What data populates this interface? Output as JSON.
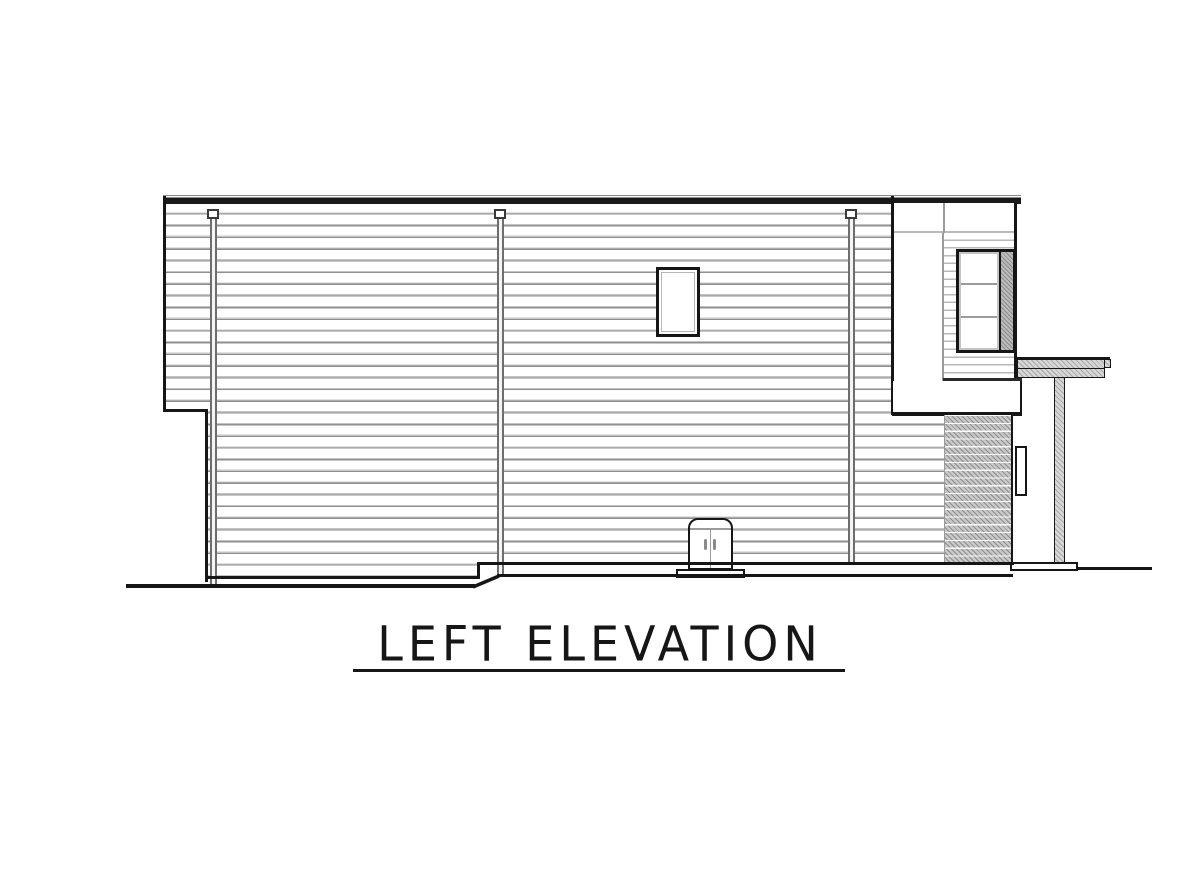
{
  "title": {
    "text": "LEFT ELEVATION"
  },
  "drawing": {
    "type": "architectural-elevation",
    "colors": {
      "background": "#ffffff",
      "line": "#161616",
      "line_gray": "#9a9a9a",
      "siding_light": "#c4c4c4",
      "siding_dark": "#8f8f8f",
      "hatch_fill": "#c9c9c9",
      "hatch_stroke": "#8c8c8c"
    },
    "components": [
      "roof-fascia",
      "main-wall-siding",
      "upper-window",
      "utility-door",
      "window-bay",
      "bay-window-3-pane",
      "lower-hatched-wall",
      "porch-roof",
      "porch-post",
      "porch-slab",
      "downspout-left",
      "downspout-middle",
      "downspout-right",
      "grade-line"
    ]
  }
}
